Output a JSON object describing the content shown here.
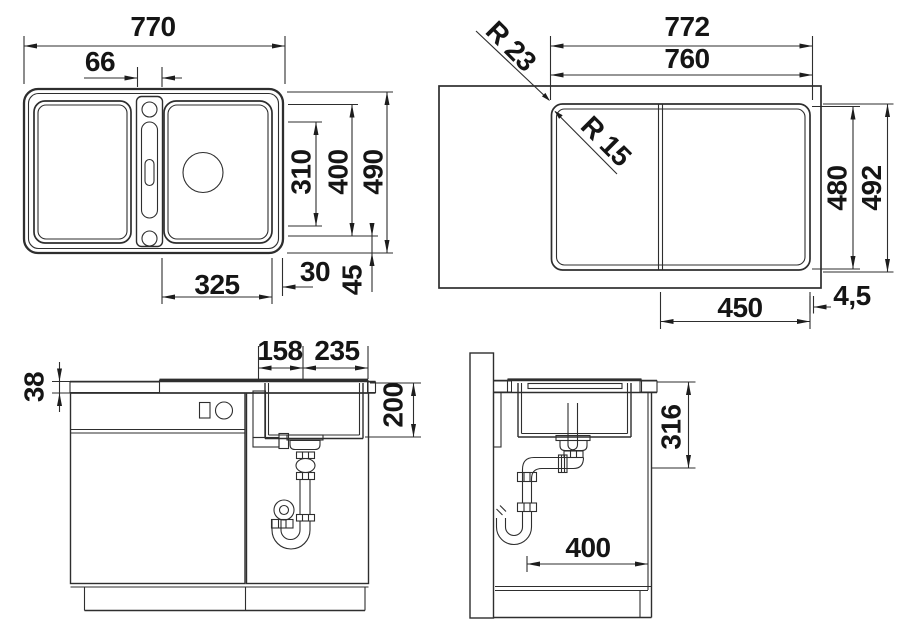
{
  "views": {
    "plan": {
      "dims": {
        "overall_width": "770",
        "ledge_width": "66",
        "bowl_inner_depth": "310",
        "bowl_outer_depth": "400",
        "overall_depth": "490",
        "bowl_width": "325",
        "side_gap": "30",
        "front_gap": "45"
      }
    },
    "cutout": {
      "dims": {
        "overall_width": "772",
        "cutout_width": "760",
        "outer_radius": "R 23",
        "inner_radius": "R 15",
        "cutout_depth": "480",
        "overall_depth": "492",
        "bowl_section_width": "450",
        "edge_gap": "4,5"
      }
    },
    "front": {
      "dims": {
        "worktop_thickness": "38",
        "drain_offset_left": "158",
        "drain_offset_right": "235",
        "bowl_depth": "200"
      }
    },
    "side": {
      "dims": {
        "underbowl_clearance": "316",
        "wall_clearance": "400"
      }
    }
  }
}
